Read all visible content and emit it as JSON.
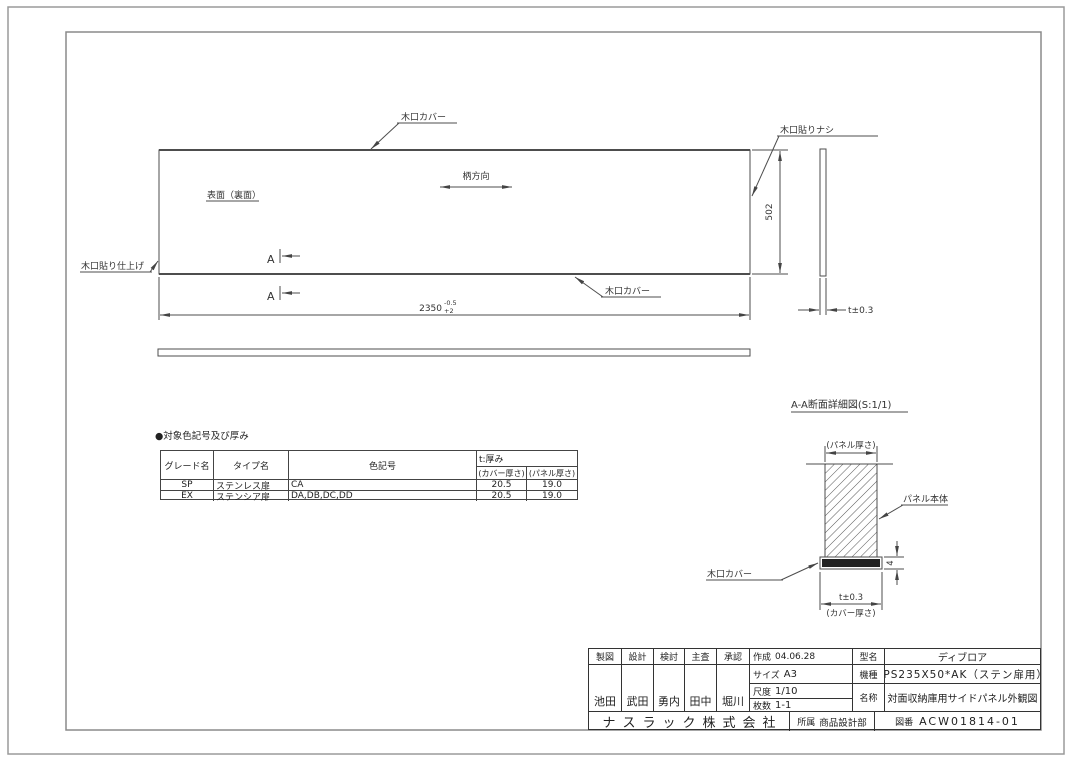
{
  "colors": {
    "line": "#4d4d4d",
    "text": "#333333",
    "border": "#999999",
    "dark_fill": "#222222"
  },
  "drawing": {
    "front_view": {
      "edge_cover_top": "木口カバー",
      "edge_cover_bottom": "木口カバー",
      "edge_no_tape": "木口貼りナシ",
      "edge_finish": "木口貼り仕上げ",
      "surface": "表面（裏面）",
      "grain_direction": "柄方向",
      "section_marker_1": "A",
      "section_marker_2": "A",
      "dim_width": "2350",
      "dim_width_tol_top": "-0.5",
      "dim_width_tol_bottom": "+2",
      "dim_height": "502"
    },
    "side_view": {
      "dim_thickness": "t±0.3"
    },
    "section_view": {
      "title": "A-A断面詳細図(S:1/1)",
      "panel_thickness_label": "(パネル厚さ)",
      "panel_body_label": "パネル本体",
      "edge_cover_label": "木口カバー",
      "cover_height_dim": "4",
      "thickness_dim": "t±0.3",
      "cover_thickness_label": "(カバー厚さ)"
    }
  },
  "color_table": {
    "title": "●対象色記号及び厚み",
    "headers": {
      "grade": "グレード名",
      "type": "タイプ名",
      "color_code": "色記号",
      "thickness": "t:厚み",
      "cover_thickness": "(カバー厚さ)",
      "panel_thickness": "(パネル厚さ)"
    },
    "rows": [
      {
        "grade": "SP",
        "type": "ステンレス扉",
        "color_code": "CA",
        "cover": "20.5",
        "panel": "19.0"
      },
      {
        "grade": "EX",
        "type": "ステンシア扉",
        "color_code": "DA,DB,DC,DD",
        "cover": "20.5",
        "panel": "19.0"
      }
    ]
  },
  "title_block": {
    "roles": [
      "製図",
      "設計",
      "検討",
      "主査",
      "承認"
    ],
    "signers": [
      "池田",
      "武田",
      "勇内",
      "田中",
      "堀川"
    ],
    "created_label": "作成",
    "created": "04.06.28",
    "size_label": "サイズ",
    "size": "A3",
    "scale_label": "尺度",
    "scale": "1/10",
    "sheets_label": "枚数",
    "sheets": "1-1",
    "model_label": "型名",
    "model": "ディブロア",
    "machine_label": "機種",
    "machine": "*PS235X50*AK（ステン扉用）",
    "name_label": "名称",
    "name": "対面収納庫用サイドパネル外観図",
    "company": "ナスラック株式会社",
    "dept_label": "所属",
    "dept": "商品設計部",
    "dwg_no_label": "図番",
    "dwg_no": "ACW01814-01"
  }
}
